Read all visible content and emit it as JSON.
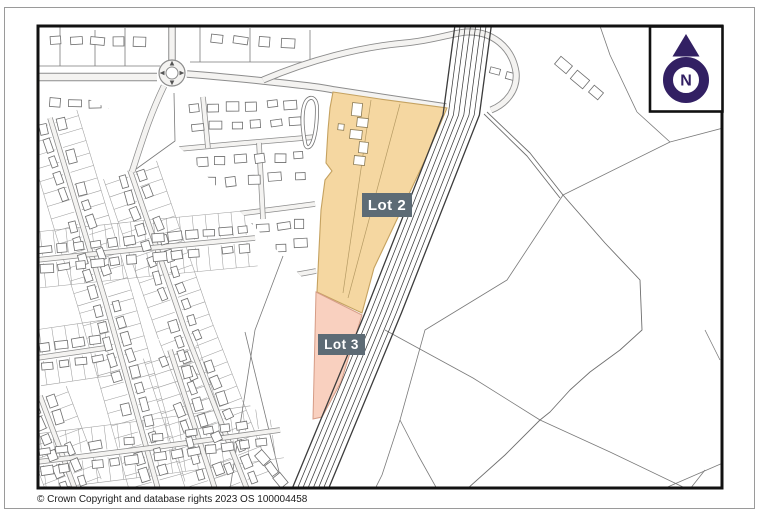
{
  "map": {
    "lot2_label": "Lot 2",
    "lot3_label": "Lot 3",
    "north_label": "N",
    "copyright": "© Crown Copyright and database rights 2023 OS 100004458"
  },
  "colors": {
    "lot2_fill": "#F5D7A1",
    "lot2_stroke": "#C5A260",
    "lot3_fill": "#F9D0BF",
    "lot3_stroke": "#D69C86",
    "label_bg": "#5D6B75",
    "label_text": "#FFFFFF",
    "north_purple": "#322063",
    "frame": "#111111",
    "linework": "#6F6F6F"
  }
}
